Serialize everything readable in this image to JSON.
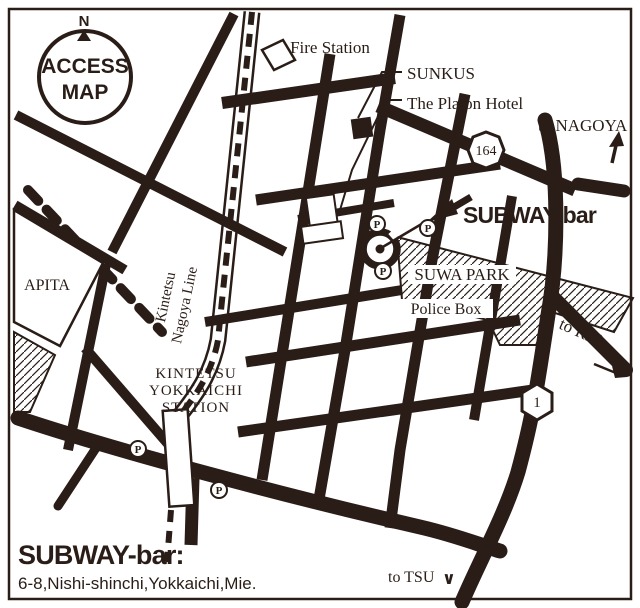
{
  "colors": {
    "ink": "#2a1d17",
    "bg": "#ffffff"
  },
  "compass": {
    "north": "N",
    "title_line1": "ACCESS",
    "title_line2": "MAP"
  },
  "labels": {
    "fire_station": "Fire Station",
    "sunkus": "SUNKUS",
    "platon_hotel": "The Platon Hotel",
    "to_nagoya": "to NAGOYA",
    "subway_bar": "SUBWAY-bar",
    "apita": "APITA",
    "kintetsu_line_1": "Kintetsu",
    "kintetsu_line_2": "Nagoya Line",
    "suwa_park": "SUWA PARK",
    "police_box": "Police Box",
    "station_line_1": "KINTETSU",
    "station_line_2": "YOKKAICHI",
    "station_line_3": "STATION",
    "to_r23": "to R23",
    "to_tsu": "to TSU",
    "tsu_arrow": "∨",
    "parking": "P"
  },
  "shields": {
    "route_164": "164",
    "route_1": "1"
  },
  "footer": {
    "name": "SUBWAY-bar:",
    "address": "6-8,Nishi-shinchi,Yokkaichi,Mie."
  }
}
